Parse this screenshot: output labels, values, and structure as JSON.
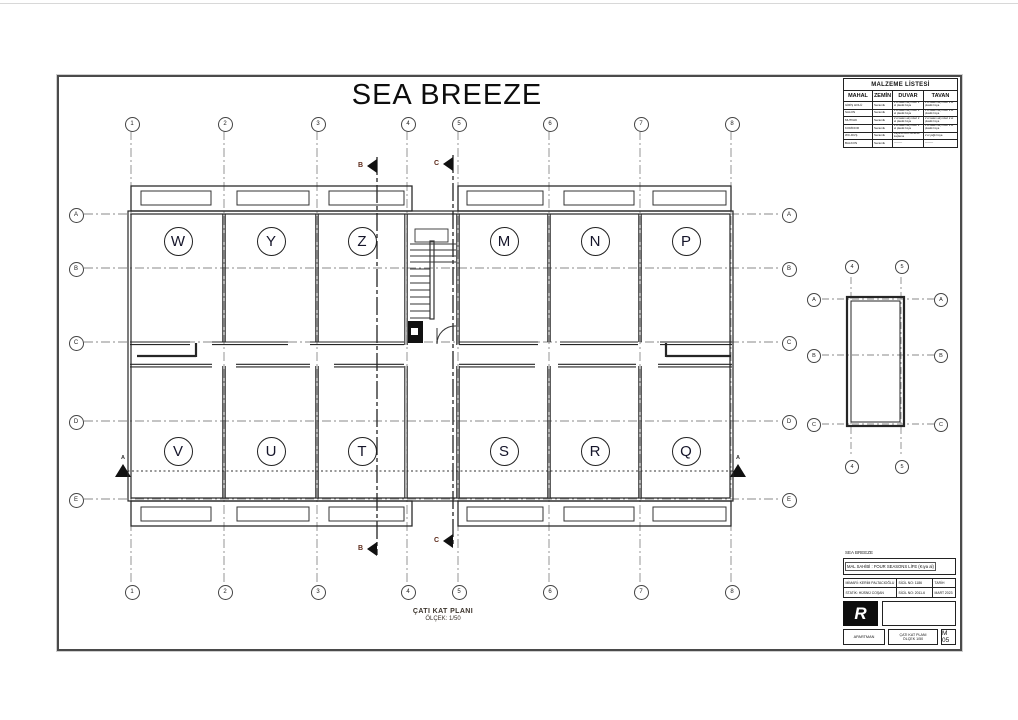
{
  "title": "SEA BREEZE",
  "caption": {
    "l1": "ÇATI KAT PLANI",
    "l2": "ÖLÇEK: 1/50"
  },
  "grid": {
    "cols": [
      "1",
      "2",
      "3",
      "4",
      "5",
      "6",
      "7",
      "8"
    ],
    "rows": [
      "A",
      "B",
      "C",
      "D",
      "E"
    ]
  },
  "rooms": {
    "top": [
      "W",
      "Y",
      "Z",
      "M",
      "N",
      "P"
    ],
    "bottom": [
      "V",
      "U",
      "T",
      "S",
      "R",
      "Q"
    ]
  },
  "sections": {
    "a": "A",
    "b": "B",
    "c": "C"
  },
  "side_plan": {
    "cols": [
      "4",
      "5"
    ],
    "rows": [
      "A",
      "B",
      "C"
    ]
  },
  "materials_table": {
    "title": "MALZEME LİSTESİ",
    "headers": [
      "MAHAL",
      "ZEMİN",
      "DUVAR",
      "TAVAN"
    ],
    "rows": [
      [
        "GİRİŞ HOLÜ",
        "Seramik",
        "2 el saten alçı üzeri 2 el plastik boya",
        "2 el saten alçı üzeri 2 el plastik boya"
      ],
      [
        "SALON",
        "Seramik",
        "2 el saten alçı üzeri 2 el plastik boya",
        "2 el saten alçı üzeri 2 el plastik boya"
      ],
      [
        "MUTFAK",
        "Seramik",
        "2 el saten alçı üzeri 2 el plastik boya",
        "2 el saten alçı üzeri 2 el plastik boya"
      ],
      [
        "KORİDOR",
        "Seramik",
        "2 el saten alçı üzeri 2 el plastik boya",
        "2 el saten alçı üzeri 2 el plastik boya"
      ],
      [
        "WC-DUŞ",
        "Seramik",
        "Fayans üzeri seramik kaplama",
        "2 el yağlı boya"
      ],
      [
        "BALKON",
        "Seramik",
        "———",
        "———"
      ]
    ]
  },
  "title_block": {
    "project": "SEA BREEZE",
    "owner": "MAL SAHİBİ : FOUR SEASONS LİFE (Kıya al)",
    "architect": "MİMARİ: KERİM PALTACIOĞLU",
    "architect_reg": "SİCİL NO: 1186",
    "static": "STATİK: HÜSNÜ COŞAN",
    "static_reg": "SİCİL NO: 2011-6",
    "date_label": "TARİH",
    "date_value": "MART 2023",
    "logo": "R",
    "apartman": "APARTMAN",
    "sheet_title": "ÇATI KAT PLANI",
    "sheet_scale": "ÖLÇEK 1/50",
    "sheet_no": "M 05"
  },
  "colors": {
    "line": "#2a2a2a",
    "grid_line": "#8a8a8a",
    "section_label": "#5d2a1a"
  }
}
